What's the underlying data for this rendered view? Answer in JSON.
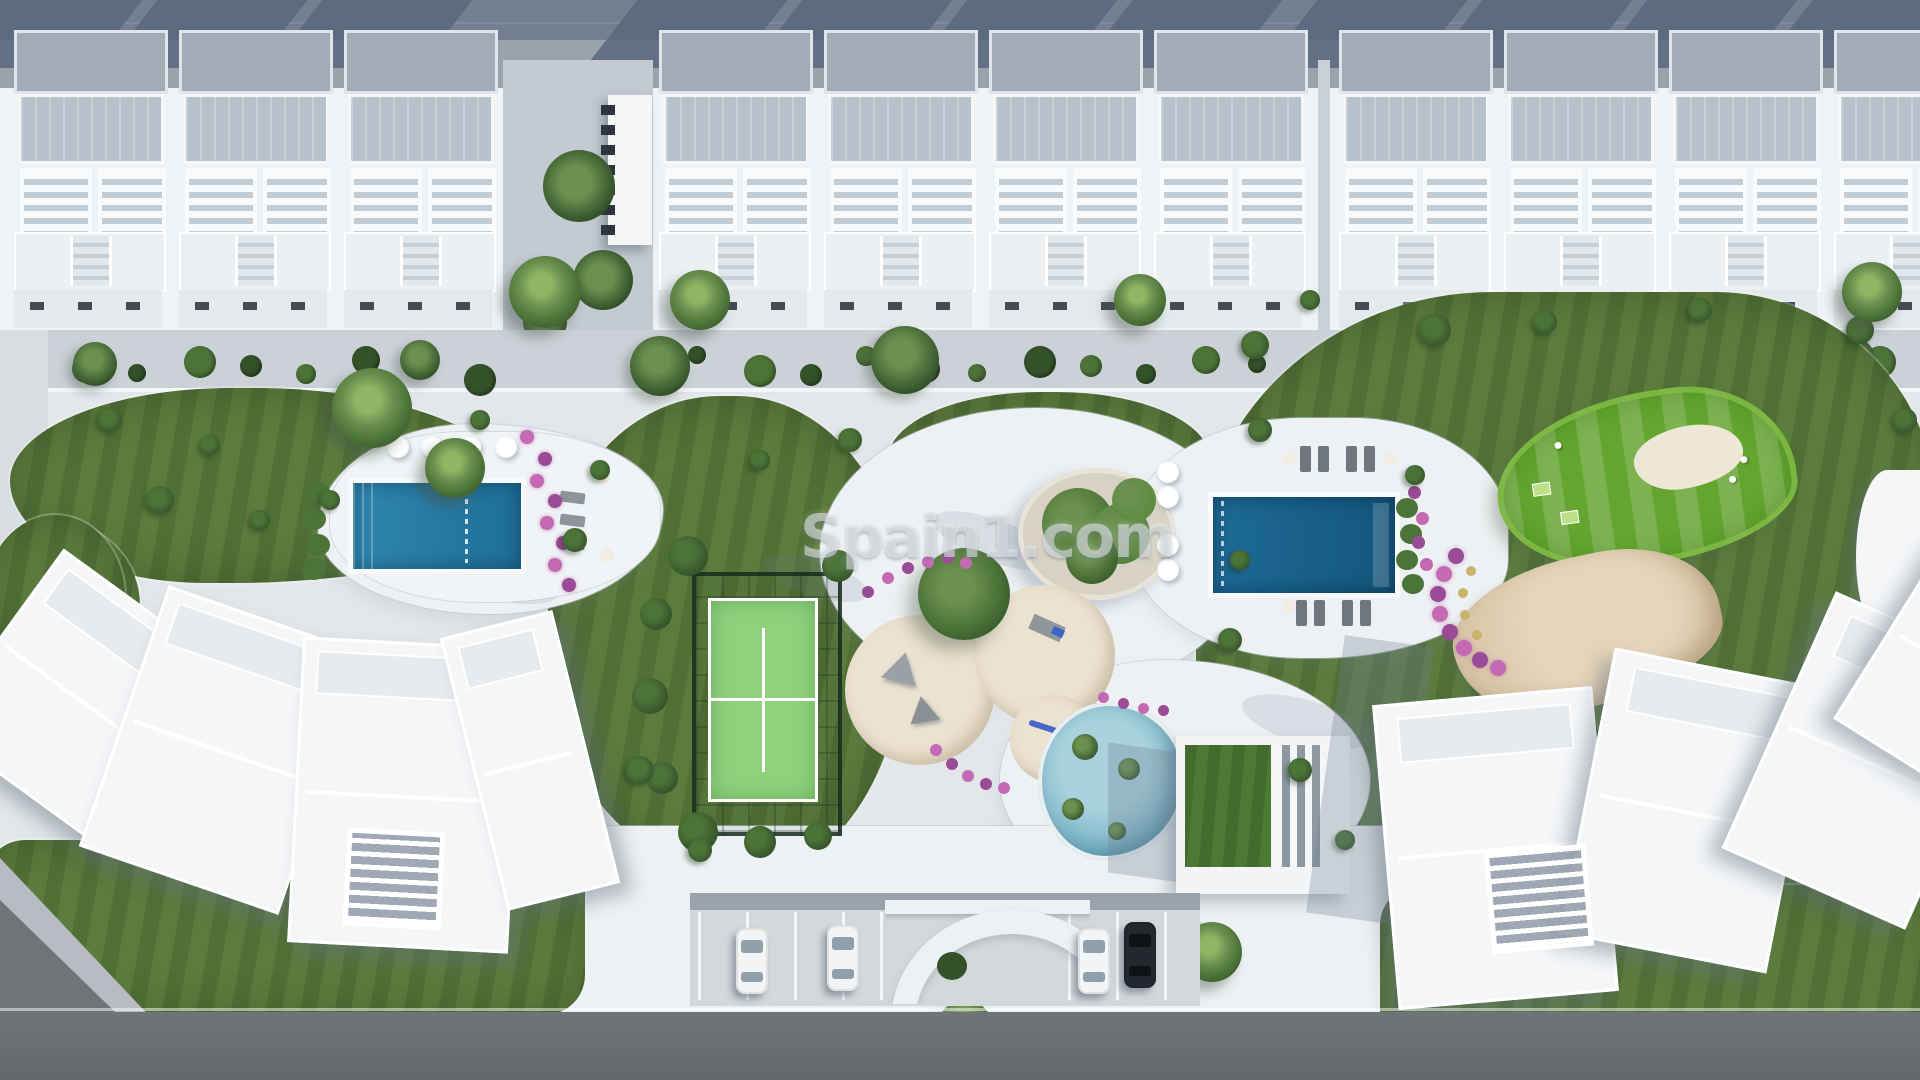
{
  "watermark": {
    "text": "Spain1.com",
    "color": "rgba(238,242,245,0.52)"
  },
  "scene": {
    "description": "aerial-3d-render-residential-resort",
    "areas": [
      "top-road",
      "townhouse-row",
      "garden-strip",
      "central-park",
      "apartment-building-left",
      "apartment-building-right",
      "parking-area",
      "bottom-road"
    ],
    "amenities": [
      "left-pool",
      "right-pool",
      "lagoon-pool",
      "padel-court",
      "playground",
      "putting-green",
      "sand-bunker",
      "clubhouse-green-roof",
      "central-planter",
      "entrance-arch",
      "sun-loungers",
      "parasols"
    ],
    "townhouse_module_count": 11,
    "parking": {
      "car_count": 4,
      "cars": [
        {
          "id": "car-1",
          "color": "white"
        },
        {
          "id": "car-2",
          "color": "white"
        },
        {
          "id": "car-3",
          "color": "white"
        },
        {
          "id": "car-4",
          "color": "dark"
        }
      ]
    }
  },
  "palette": {
    "ground": "#e3e7ea",
    "plaza": "#eef1f3",
    "deck": "#f1f4f6",
    "roadTop": "#9aa2ab",
    "roadDark": "#6e7478",
    "shadowTop": "#56657c",
    "roofWhite": "#f4f6f8",
    "roofBack": "#a2acb6",
    "terrace": "#b7c1cb",
    "pergolaGap": "#c2ccd5",
    "lawn": "#5b7c3d",
    "lawnStripe": "rgba(15,35,8,0.14)",
    "golf": "#63a52f",
    "golfStripe": "rgba(255,255,255,0.16)",
    "bushDark": "#33522a",
    "bushMid": "#4c7338",
    "bushLight": "#6b9150",
    "sandPlay": "#e2d7c3",
    "bunker": "#d9c6a9",
    "gravel": "#d8d2c5",
    "poolL1": "#2f86ae",
    "poolL2": "#1e6e98",
    "poolR1": "#1d6b96",
    "poolR2": "#14567c",
    "lagoon1": "#a9d2dd",
    "lagoon2": "#5f9fb5",
    "court": "#8ed27e",
    "courtLine": "#ffffff",
    "fence": "#22362a",
    "flowerPink": "#c46ab4",
    "flowerPurple": "#9a4b96",
    "flowerYellow": "#c9b26a",
    "carWhite": "#f2f4f5",
    "carDark": "#23272e",
    "glass": "#8fa0ac",
    "wall": "#9aa3ab",
    "lot": "#d3d8db",
    "pathLight": "#d8dde1",
    "shadowSoft": "rgba(110,125,145,0.30)"
  }
}
